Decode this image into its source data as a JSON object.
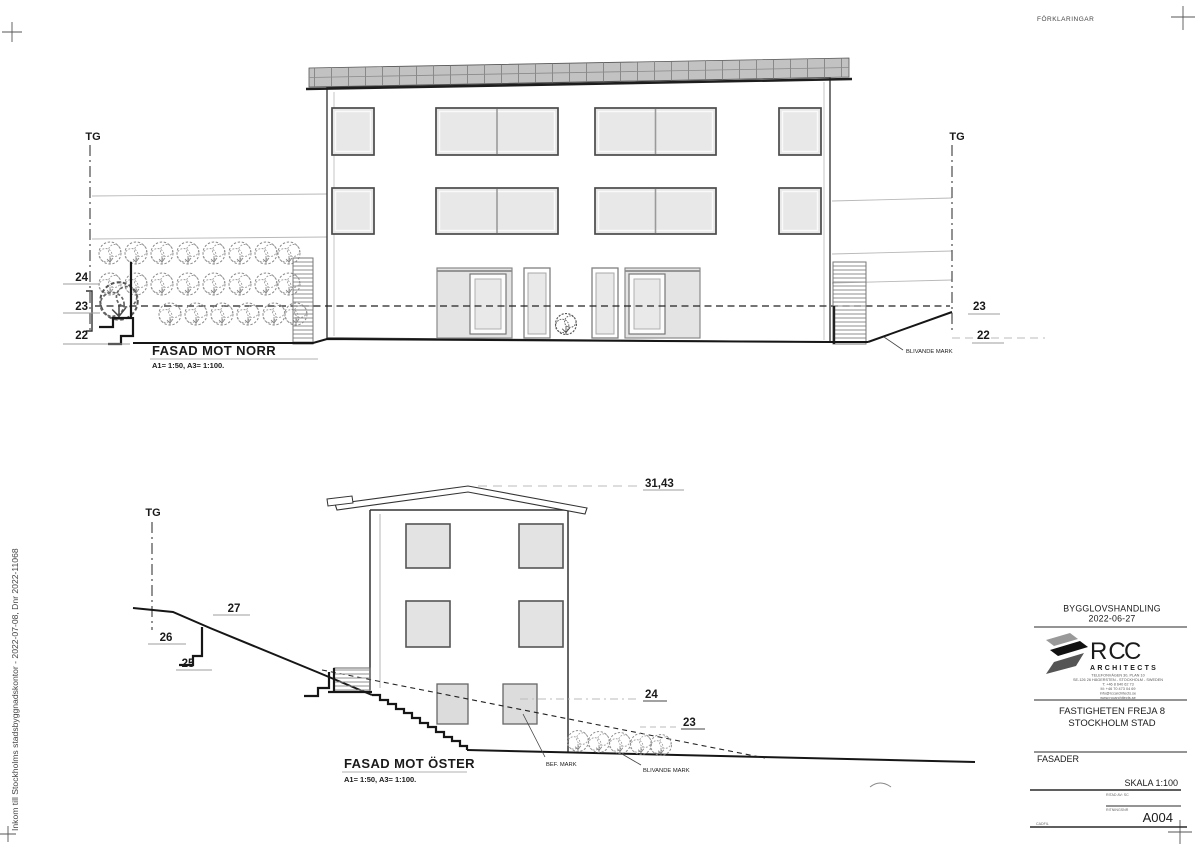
{
  "sheet": {
    "legend_title": "FÖRKLARINGAR",
    "stamp_vertical": "Inkom till Stockholms stadsbyggnadskontor - 2022-07-08, Dnr 2022-11068",
    "colors": {
      "accent": "#e8490f",
      "line": "#1a1a1a",
      "window_fill": "#e8e8e8",
      "roof_fill": "#c2c2c2"
    }
  },
  "north_facade": {
    "title": "FASAD MOT NORR",
    "scale_note": "A1= 1:50, A3= 1:100.",
    "grid_label_left": "TG",
    "grid_label_right": "TG",
    "levels_left": [
      "24",
      "23",
      "22"
    ],
    "levels_right": [
      "23",
      "22"
    ],
    "blivande_mark": "BLIVANDE MARK"
  },
  "east_facade": {
    "title": "FASAD MOT ÖSTER",
    "scale_note": "A1= 1:50, A3= 1:100.",
    "grid_label": "TG",
    "ridge_level": "31,43",
    "levels_left": [
      "27",
      "26",
      "25"
    ],
    "levels_right": [
      "24",
      "23"
    ],
    "bef_mark": "BEF. MARK",
    "blivande_mark": "BLIVANDE MARK"
  },
  "title_block": {
    "document_type": "BYGGLOVSHANDLING",
    "date": "2022-06-27",
    "logo": {
      "name_orange": "RC",
      "name_dark": "C",
      "subtitle": "ARCHITECTS",
      "address_lines": [
        "TELEFONVÄGEN 30, PLAN 10",
        "SE-126 26 HÄGERSTEN - STOCKHOLM - SWEDEN",
        "T: +46 8 640 62 73",
        "M: +46 70 473 04 69",
        "info@rccarchitects.se",
        "www.rccarchitects.se"
      ]
    },
    "project_name": "FASTIGHETEN FREJA 8",
    "project_city": "STOCKHOLM STAD",
    "sheet_content": "FASADER",
    "scale": "SKALA 1:100",
    "drawn_by": "RITAD AV: SC",
    "number_caption": "RITNINGSNR",
    "drawing_number": "A004",
    "file_caption": "CADFIL"
  }
}
